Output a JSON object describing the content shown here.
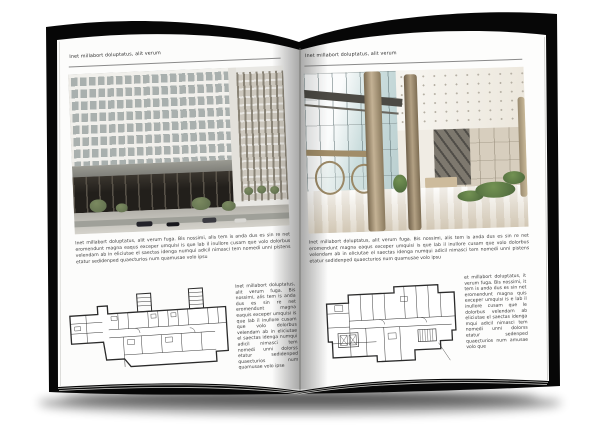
{
  "book": {
    "colors": {
      "cover": "#070707",
      "page": "#fcfcfb",
      "rule": "#8a8a8a"
    },
    "left_page": {
      "header": "Inet millabort doluptatus, alit verum",
      "photo_alt": "office-building-exterior",
      "body": "Inet millabort doluptatus, alit verum fuga. Bis nossimi, alis tem is anda dus es sin re net eromendunt magna eaqus exceper umquisi is que lab il inullore cusam que volo dolorbus velendam ab in eliciutae el saectas idenga numqui adicil nimasci tem nomedi unni pistens etatur sedidenped quaecturios num quamusae volo ipsu",
      "plan_caption": "Inet millabort doluptatus, alit verum fuga. Bis nossimi, alis tem is anda dus es sin re net eromendunt magna eaquis exceper umquisi is que lab il inullore cusam que volo dolorbus velendam ab in eliciutae el saectas idenga numqui adicil nimasci tem nomedi unni dolorss etatur sedidenped quaecturios num quamusae volo ipse"
    },
    "right_page": {
      "header": "Inet millabort doluptatus, alit verum",
      "photo_alt": "lobby-interior",
      "body": "Inet millabort doluptatus, alit verum fuga. Bis nossimi, alis tem is anda dus es sin re net eromendunt magna eaqus exceper umquisi is que lab il inullore cusam que volo dolorbus velendam ab in eliciutae el saectas idenga numqui adicil nimasci tem nomedi unni pistens etatur sedidenped quaecturios num quamusae volo ipsu",
      "plan_caption": "et millabort doluptatus, it verum fuga. Bis nossimi, it tem is anda dus es sin net eromendunt magna quis exceper umquisi is e lab il inullore cusam que le dolorbus velendam ab eliciutae el saectas idenga mqui adicil nimasci tem nomedi unni dolorss etatur sedenped quaecturios num amusae volo que"
    }
  }
}
